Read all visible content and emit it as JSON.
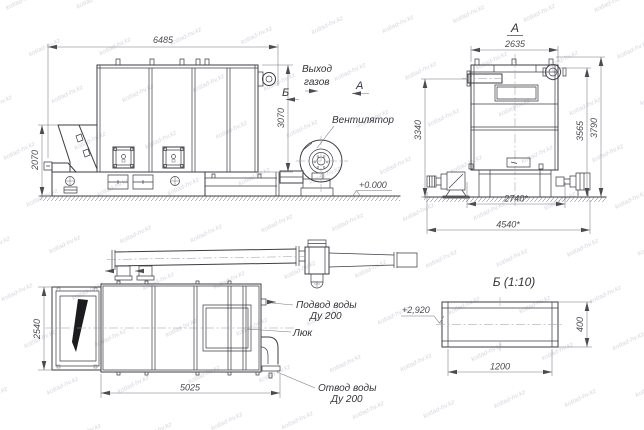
{
  "drawing": {
    "watermark": "kotlad-hv.kz",
    "side_view": {
      "dim_length": "6485",
      "dim_height": "3070",
      "dim_hopper_height": "2070",
      "label_gas_outlet_line1": "Выход",
      "label_gas_outlet_line2": "газов",
      "label_fan": "Вентилятор",
      "label_level_zero": "+0.000",
      "marker_section_b": "Б",
      "marker_view_a": "А"
    },
    "front_view": {
      "title": "А",
      "dim_width": "2635",
      "dim_height_pipe": "3340",
      "dim_height_body": "3565",
      "dim_height_total": "3790",
      "dim_base_inner": "2740*",
      "dim_base_outer": "4540*"
    },
    "plan_view": {
      "dim_width": "2540",
      "dim_length": "5025",
      "label_water_inlet_line1": "Подвод воды",
      "label_water_inlet_line2": "Ду 200",
      "label_hatch": "Люк",
      "label_water_outlet_line1": "Отвод воды",
      "label_water_outlet_line2": "Ду 200"
    },
    "detail_view": {
      "title": "Б (1:10)",
      "dim_length": "1200",
      "dim_height": "400",
      "label_level": "+2,920"
    }
  }
}
